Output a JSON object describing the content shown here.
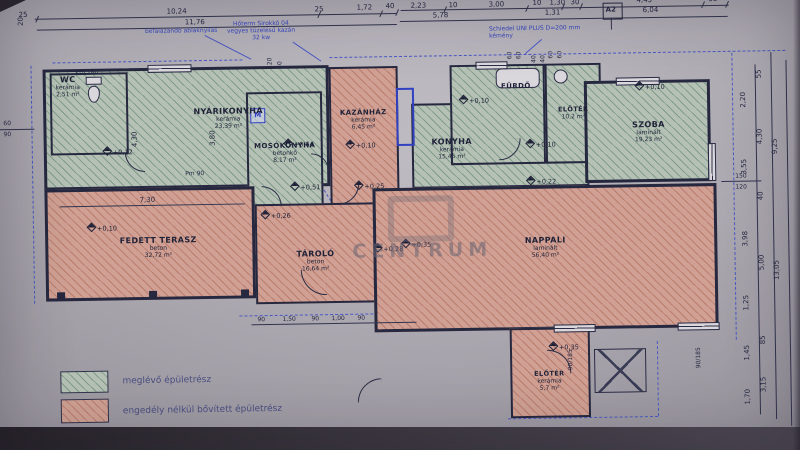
{
  "watermark": "CENTRUM",
  "legend": {
    "existing_label": "meglévő épületrész",
    "unpermitted_label": "engedély nélkül bővített épületrész"
  },
  "notes": {
    "left": "befalazandó ablaknyílás",
    "boiler": "Hőterm Sirokkó 04\nvegyes tüzelésű kazán\n32 kw",
    "chimney": "Schiedel UNI PLUS D=200 mm\nkémény",
    "marker": "A2",
    "m_box": "M"
  },
  "rooms": {
    "wc": {
      "name": "WC",
      "material": "kerámia",
      "area": "2,51 m²"
    },
    "nyari": {
      "name": "NYÁRIKONYHA",
      "material": "kerámia",
      "area": "23,39 m²"
    },
    "moso": {
      "name": "MOSÓKONYHA",
      "material": "betonkő",
      "area": "8,17 m²"
    },
    "kazan": {
      "name": "KAZÁNHÁZ",
      "material": "kerámia",
      "area": "6,45 m²"
    },
    "konyha": {
      "name": "KONYHA",
      "material": "kerámia",
      "area": "15,45 m²"
    },
    "furdo": {
      "name": "FÜRDŐ"
    },
    "kamra": {
      "name": "ELŐTÉR",
      "area": "10,2 m²"
    },
    "szoba": {
      "name": "SZOBA",
      "material": "laminált",
      "area": "19,23 m²"
    },
    "terasz": {
      "name": "FEDETT TERASZ",
      "material": "beton",
      "area": "32,72 m²"
    },
    "tarolo": {
      "name": "TÁROLÓ",
      "material": "beton",
      "area": "16,64 m²"
    },
    "nappali": {
      "name": "NAPPALI",
      "material": "laminált",
      "area": "56,40 m²"
    },
    "eloter": {
      "name": "ELŐTÉR",
      "material": "kerámia",
      "area": "5,7 m²"
    }
  },
  "elev": {
    "nyari": "+0,12",
    "moso": "+0,64",
    "kazan": "+0,10",
    "konyha": "+0,10",
    "furdo": "+0,10",
    "szoba": "+0,10",
    "konyha2": "+0,22",
    "terasz": "+0,10",
    "t1": "+0,26",
    "t2": "+0,51",
    "t3": "+0,25",
    "t4": "+0,28",
    "t5": "+0,35",
    "eloter": "+0,35"
  },
  "dims": {
    "corner": "20",
    "top1": [
      "25",
      "10,24",
      "25",
      "1,72",
      "40",
      "2,23",
      "10",
      "3,00",
      "10",
      "1,30",
      "30",
      "4,45",
      "55"
    ],
    "top2": [
      "11,76",
      "5,78",
      "1,31",
      "6,04"
    ],
    "chainA": [
      "2,20",
      "3,55",
      "3,98",
      "1,25",
      "1,45",
      "1,70"
    ],
    "chainB": [
      "55",
      "4,30",
      "40",
      "5,00",
      "85",
      "3,15"
    ],
    "chainC": [
      "9,25",
      "13,05"
    ],
    "left": [
      "60",
      "90"
    ],
    "vents": [
      "120",
      "80",
      "40",
      "40",
      "60",
      "60",
      "60",
      "60"
    ],
    "inner": {
      "v1": "4,30",
      "v2": "3,80",
      "h1": "7,30",
      "pm1": "Pm 180",
      "pm2": "Pm 90",
      "bottom": [
        "90",
        "1,50",
        "90",
        "1,00",
        "90"
      ],
      "winb1": "90/185",
      "winb2": "90/185",
      "winr1": "150",
      "winr2": "120"
    }
  }
}
